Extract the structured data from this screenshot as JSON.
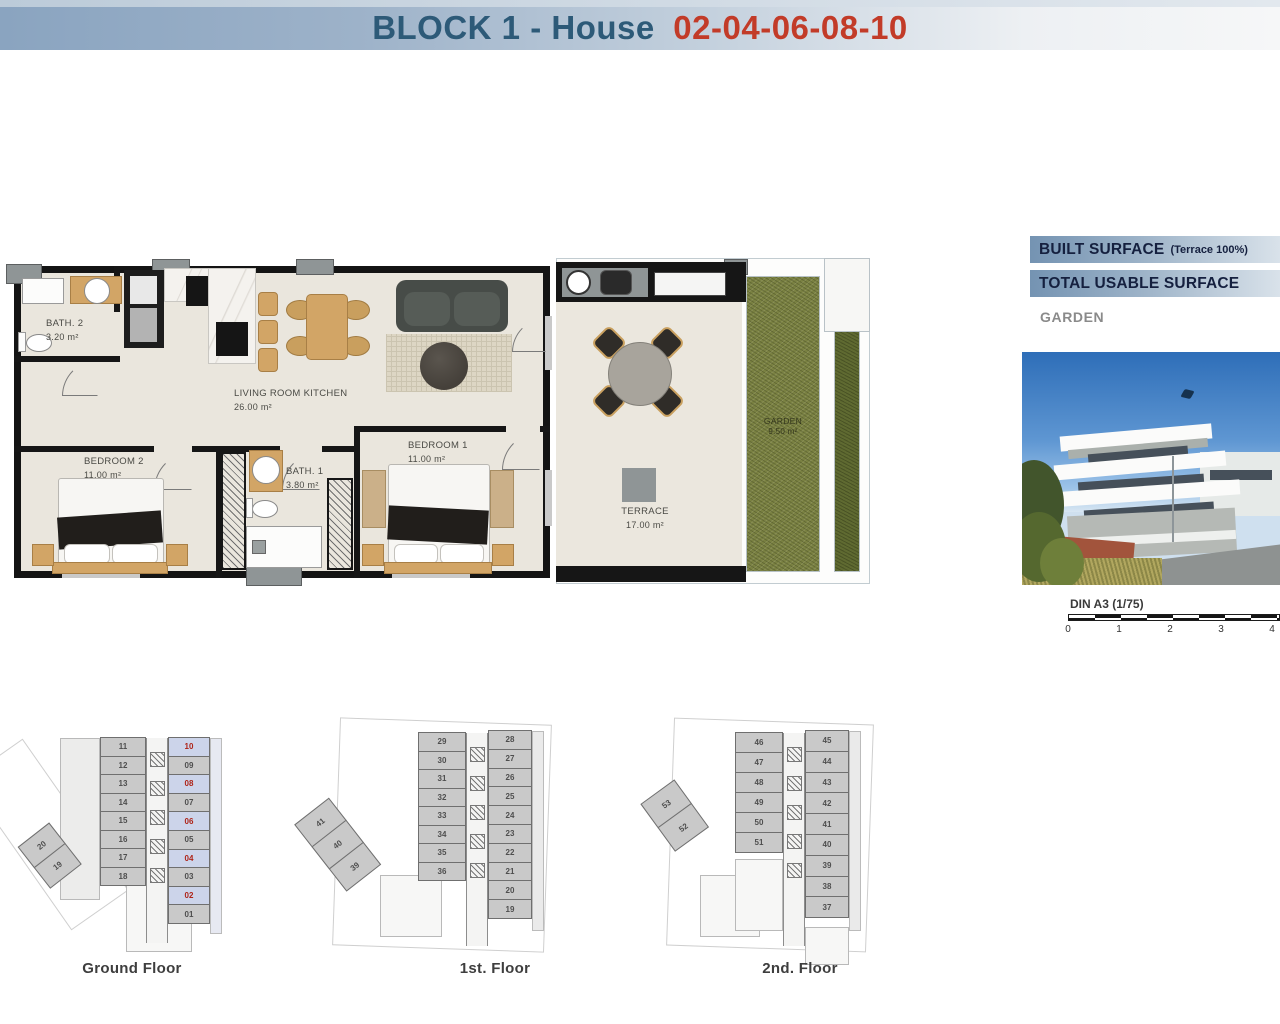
{
  "header": {
    "title": "BLOCK 1 - House",
    "house_numbers": "02-04-06-08-10"
  },
  "plan": {
    "rooms": {
      "bath2": {
        "name": "BATH. 2",
        "area": "3.20 m²"
      },
      "living": {
        "name": "LIVING ROOM KITCHEN",
        "area": "26.00 m²"
      },
      "bedroom2": {
        "name": "BEDROOM 2",
        "area": "11.00 m²"
      },
      "bath1": {
        "name": "BATH. 1",
        "area": "3.80 m²"
      },
      "bedroom1": {
        "name": "BEDROOM 1",
        "area": "11.00 m²"
      },
      "terrace": {
        "name": "TERRACE",
        "area": "17.00 m²"
      },
      "garden": {
        "name": "GARDEN",
        "area": "9.50 m²"
      }
    }
  },
  "side_panel": {
    "built_surface_label": "BUILT SURFACE",
    "built_surface_note": "(Terrace 100%)",
    "total_usable_label": "TOTAL USABLE SURFACE",
    "garden_label": "GARDEN"
  },
  "scale_bar": {
    "label": "DIN A3 (1/75)",
    "ticks": [
      "0",
      "1",
      "2",
      "3",
      "4"
    ]
  },
  "floors": [
    {
      "label": "Ground Floor",
      "left_units": [
        {
          "n": "11"
        },
        {
          "n": "12"
        },
        {
          "n": "13"
        },
        {
          "n": "14"
        },
        {
          "n": "15"
        },
        {
          "n": "16"
        },
        {
          "n": "17"
        },
        {
          "n": "18"
        }
      ],
      "right_units": [
        {
          "n": "10",
          "hl": true
        },
        {
          "n": "09"
        },
        {
          "n": "08",
          "hl": true
        },
        {
          "n": "07"
        },
        {
          "n": "06",
          "hl": true
        },
        {
          "n": "05"
        },
        {
          "n": "04",
          "hl": true
        },
        {
          "n": "03"
        },
        {
          "n": "02",
          "hl": true
        },
        {
          "n": "01"
        }
      ],
      "wing_units": [
        {
          "n": "20"
        },
        {
          "n": "19"
        }
      ]
    },
    {
      "label": "1st. Floor",
      "left_units": [
        {
          "n": "29"
        },
        {
          "n": "30"
        },
        {
          "n": "31"
        },
        {
          "n": "32"
        },
        {
          "n": "33"
        },
        {
          "n": "34"
        },
        {
          "n": "35"
        },
        {
          "n": "36"
        }
      ],
      "right_units": [
        {
          "n": "28"
        },
        {
          "n": "27"
        },
        {
          "n": "26"
        },
        {
          "n": "25"
        },
        {
          "n": "24"
        },
        {
          "n": "23"
        },
        {
          "n": "22"
        },
        {
          "n": "21"
        },
        {
          "n": "20"
        },
        {
          "n": "19"
        }
      ],
      "wing_units": [
        {
          "n": "41"
        },
        {
          "n": "40"
        },
        {
          "n": "39"
        }
      ]
    },
    {
      "label": "2nd. Floor",
      "left_units": [
        {
          "n": "46"
        },
        {
          "n": "47"
        },
        {
          "n": "48"
        },
        {
          "n": "49"
        },
        {
          "n": "50"
        },
        {
          "n": "51"
        }
      ],
      "right_units": [
        {
          "n": "45"
        },
        {
          "n": "44"
        },
        {
          "n": "43"
        },
        {
          "n": "42"
        },
        {
          "n": "41"
        },
        {
          "n": "40"
        },
        {
          "n": "39"
        },
        {
          "n": "38"
        },
        {
          "n": "37"
        }
      ],
      "wing_units": [
        {
          "n": "53"
        },
        {
          "n": "52"
        }
      ]
    }
  ],
  "colors": {
    "title_blue": "#2d5a78",
    "title_red": "#c23b28",
    "bar_gradient_start": "#7493b2",
    "highlight_bg": "#ccd4ea",
    "highlight_text": "#ae2317",
    "garden_green": "#7a8142",
    "floor_beige": "#eae6dd",
    "wall_black": "#161616"
  }
}
